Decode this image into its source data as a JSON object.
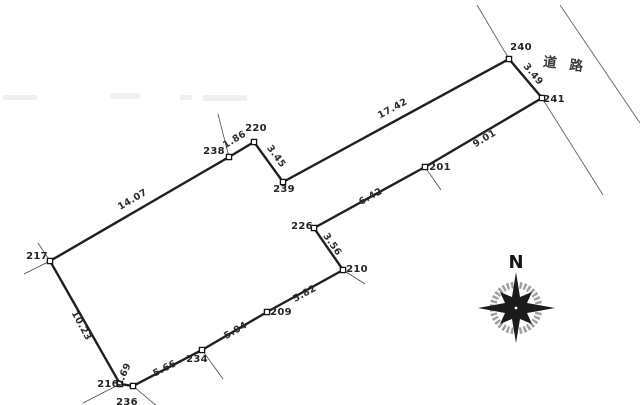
{
  "colors": {
    "outline": "#1f1f1f",
    "thin_line": "#4a4a4a",
    "road_line": "#6e6e6e",
    "text": "#262626",
    "marker_fill": "#ffffff",
    "marker_stroke": "#141414",
    "compass_ring": "#8f8f8f",
    "compass_star": "#1b1b1b",
    "artifact": "#e2e2e2"
  },
  "road": {
    "label": "道路"
  },
  "compass": {
    "north_label": "N"
  },
  "plat": {
    "points": [
      {
        "id": "217",
        "x": 50,
        "y": 261,
        "label_x": 37,
        "label_y": 259
      },
      {
        "id": "238",
        "x": 229,
        "y": 157,
        "label_x": 214,
        "label_y": 154
      },
      {
        "id": "220",
        "x": 254,
        "y": 142,
        "label_x": 256,
        "label_y": 131
      },
      {
        "id": "239",
        "x": 283,
        "y": 182,
        "label_x": 284,
        "label_y": 192
      },
      {
        "id": "240",
        "x": 509,
        "y": 59,
        "label_x": 521,
        "label_y": 50
      },
      {
        "id": "241",
        "x": 542,
        "y": 98,
        "label_x": 554,
        "label_y": 102
      },
      {
        "id": "201",
        "x": 425,
        "y": 167,
        "label_x": 440,
        "label_y": 170
      },
      {
        "id": "226",
        "x": 314,
        "y": 228,
        "label_x": 302,
        "label_y": 229
      },
      {
        "id": "210",
        "x": 343,
        "y": 270,
        "label_x": 357,
        "label_y": 272
      },
      {
        "id": "209",
        "x": 267,
        "y": 312,
        "label_x": 281,
        "label_y": 315
      },
      {
        "id": "234",
        "x": 202,
        "y": 350,
        "label_x": 197,
        "label_y": 362
      },
      {
        "id": "236",
        "x": 133,
        "y": 386,
        "label_x": 127,
        "label_y": 405
      },
      {
        "id": "216",
        "x": 120,
        "y": 384,
        "label_x": 108,
        "label_y": 387
      }
    ],
    "edges": [
      {
        "between": "217-238",
        "length": "14.07",
        "x": 134,
        "y": 202,
        "rot": -30.5
      },
      {
        "between": "238-220",
        "length": "1.86",
        "x": 236,
        "y": 142,
        "rot": -31
      },
      {
        "between": "220-239",
        "length": "3.45",
        "x": 274,
        "y": 158,
        "rot": 54
      },
      {
        "between": "239-240",
        "length": "17.42",
        "x": 394,
        "y": 111,
        "rot": -28.5
      },
      {
        "between": "240-241",
        "length": "3.49",
        "x": 531,
        "y": 76,
        "rot": 50
      },
      {
        "between": "241-201",
        "length": "9.01",
        "x": 486,
        "y": 141,
        "rot": -31
      },
      {
        "between": "201-226",
        "length": "6.42",
        "x": 372,
        "y": 199,
        "rot": -29
      },
      {
        "between": "226-210",
        "length": "3.56",
        "x": 330,
        "y": 246,
        "rot": 55
      },
      {
        "between": "210-209",
        "length": "5.82",
        "x": 306,
        "y": 296,
        "rot": -29
      },
      {
        "between": "209-234",
        "length": "5.04",
        "x": 237,
        "y": 333,
        "rot": -30
      },
      {
        "between": "234-236",
        "length": "5.66",
        "x": 166,
        "y": 371,
        "rot": -27
      },
      {
        "between": "236-216",
        "length": "0.69",
        "x": 126,
        "y": 376,
        "rot": -66
      },
      {
        "between": "216-217",
        "length": "10.23",
        "x": 79,
        "y": 327,
        "rot": 61.5
      }
    ],
    "road_lines": [
      {
        "name": "road-edge-near",
        "points": [
          [
            477,
            5
          ],
          [
            509,
            59
          ],
          [
            542,
            98
          ],
          [
            603,
            195
          ]
        ]
      },
      {
        "name": "road-edge-far",
        "points": [
          [
            560,
            5
          ],
          [
            640,
            123
          ]
        ]
      }
    ],
    "extension_lines": [
      [
        38,
        243,
        50,
        261
      ],
      [
        24,
        274,
        50,
        261
      ],
      [
        218,
        114,
        229,
        157
      ],
      [
        425,
        167,
        441,
        190
      ],
      [
        343,
        270,
        365,
        284
      ],
      [
        202,
        350,
        223,
        379
      ],
      [
        83,
        403,
        120,
        384
      ],
      [
        133,
        386,
        158,
        407
      ]
    ],
    "scan_artifacts": [
      [
        3,
        95,
        34,
        5
      ],
      [
        110,
        93,
        30,
        6
      ],
      [
        180,
        95,
        12,
        5
      ],
      [
        203,
        95,
        44,
        6
      ]
    ]
  }
}
